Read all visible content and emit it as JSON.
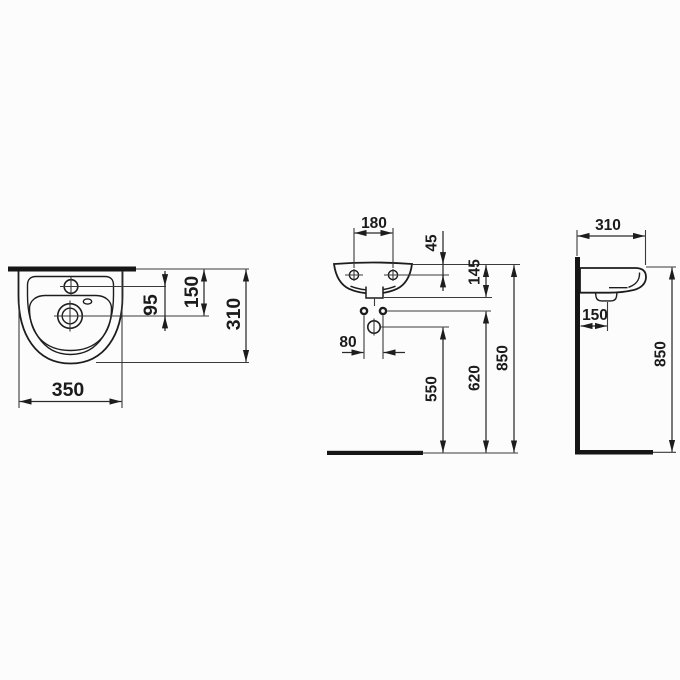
{
  "colors": {
    "ink": "#1d1d1d",
    "background": "#fcfcfc"
  },
  "top_view": {
    "overall_width": "350",
    "tap_hole_to_drain": "95",
    "top_edge_to_drain": "150",
    "overall_depth": "310"
  },
  "front_view": {
    "fixing_hole_spacing": "180",
    "top_edge_to_fixing_holes": "45",
    "top_edge_to_underside": "145",
    "supply_spacing": "80",
    "floor_to_waste": "550",
    "floor_to_supply": "620",
    "floor_to_rim": "850"
  },
  "side_view": {
    "overall_depth": "310",
    "wall_to_waste": "150",
    "floor_to_rim": "850"
  }
}
